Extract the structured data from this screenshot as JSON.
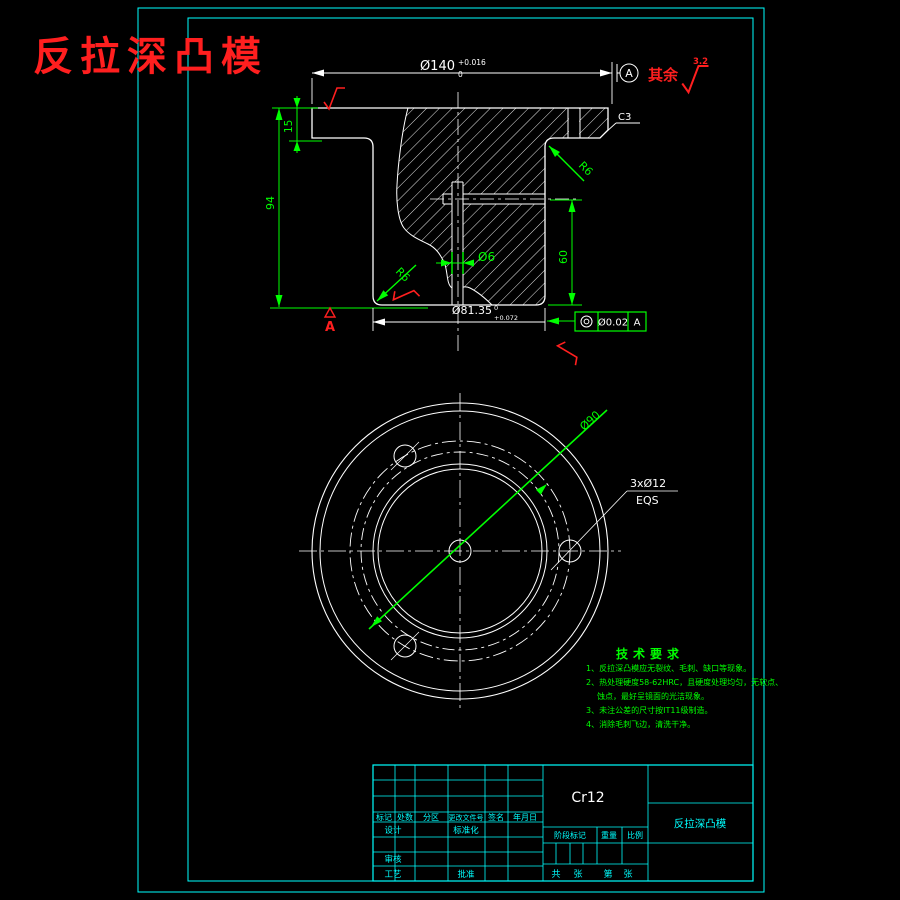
{
  "title": "反拉深凸模",
  "colors": {
    "background": "#000000",
    "geometry": "#ffffff",
    "dimension": "#00ff00",
    "annotation": "#ff1f1f",
    "frame": "#00ffff"
  },
  "section": {
    "dia140": {
      "value": "Ø140",
      "sup": "+0.016",
      "sub": "0"
    },
    "datum_circle_label": "A",
    "rest_label": "其余",
    "rest_value": "3.2",
    "chamfer": "C3",
    "h15": "15",
    "h94": "94",
    "h60": "60",
    "d6": "Ø6",
    "r6_upper": "R6",
    "r6_lower": "R6",
    "dia8135": {
      "value": "Ø81.35",
      "sup": "0",
      "sub": "+0.072"
    },
    "gdt": {
      "symbol_name": "concentricity",
      "tolerance": "Ø0.02",
      "datum": "A"
    },
    "datum_flag": "A"
  },
  "plan": {
    "bolt_circle_dia": "Ø90",
    "holes_label": "3xØ12",
    "holes_note": "EQS"
  },
  "tech": {
    "title": "技术要求",
    "lines": [
      "1、反拉深凸模应无裂纹、毛刺、缺口等现象。",
      "2、热处理硬度58-62HRC，且硬度处理均匀，无软点、",
      "蚀点，最好呈镜面的光洁现象。",
      "3、未注公差的尺寸按IT11级制造。",
      "4、消除毛刺飞边，清洗干净。"
    ]
  },
  "tb": {
    "material": "Cr12",
    "part": "反拉深凸模",
    "h": [
      "标记",
      "处数",
      "分区",
      "更改文件号",
      "签名",
      "年月日"
    ],
    "design": "设计",
    "standard": "标准化",
    "audit": "审核",
    "process": "工艺",
    "approve": "批准",
    "stage": "阶段标记",
    "weight": "重量",
    "scale": "比例",
    "sheets": [
      "共",
      "张",
      "第",
      "张"
    ]
  }
}
